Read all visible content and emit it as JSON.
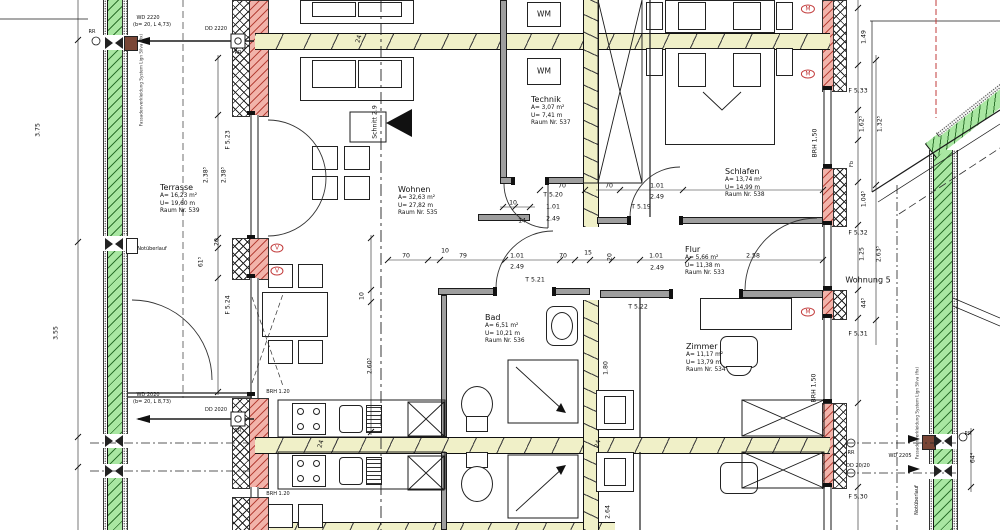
{
  "drawing": {
    "rooms": [
      {
        "id": "terrasse",
        "name": "Terrasse",
        "area": "A= 16,23 m²",
        "perimeter": "U= 19,60 m",
        "room_no": "Raum Nr. 539",
        "x": 160,
        "y": 183
      },
      {
        "id": "wohnen",
        "name": "Wohnen",
        "area": "A= 32,63 m²",
        "perimeter": "U= 27,82 m",
        "room_no": "Raum Nr. 535",
        "x": 398,
        "y": 185
      },
      {
        "id": "technik",
        "name": "Technik",
        "area": "A= 3,07 m²",
        "perimeter": "U= 7,41 m",
        "room_no": "Raum Nr. 537",
        "x": 531,
        "y": 95
      },
      {
        "id": "schlafen",
        "name": "Schlafen",
        "area": "A= 13,74 m²",
        "perimeter": "U= 14,99 m",
        "room_no": "Raum Nr. 538",
        "x": 725,
        "y": 167
      },
      {
        "id": "flur",
        "name": "Flur",
        "area": "A= 5,66 m²",
        "perimeter": "U= 11,38 m",
        "room_no": "Raum Nr. 533",
        "x": 685,
        "y": 245
      },
      {
        "id": "bad",
        "name": "Bad",
        "area": "A= 6,51 m²",
        "perimeter": "U= 10,21 m",
        "room_no": "Raum Nr. 536",
        "x": 485,
        "y": 313
      },
      {
        "id": "zimmer",
        "name": "Zimmer",
        "area": "A= 11,17 m²",
        "perimeter": "U= 13,79 m",
        "room_no": "Raum Nr. 534",
        "x": 686,
        "y": 342
      }
    ],
    "annotations": [
      {
        "t": "T 5.20",
        "x": 553,
        "y": 195
      },
      {
        "t": "1.01",
        "x": 553,
        "y": 207
      },
      {
        "t": "2.49",
        "x": 553,
        "y": 219
      },
      {
        "t": "10",
        "x": 513,
        "y": 203
      },
      {
        "t": "14",
        "x": 522,
        "y": 221
      },
      {
        "t": "T 5.19",
        "x": 641,
        "y": 207
      },
      {
        "t": "70",
        "x": 562,
        "y": 186
      },
      {
        "t": "70",
        "x": 609,
        "y": 186
      },
      {
        "t": "1.01",
        "x": 657,
        "y": 186
      },
      {
        "t": "2.49",
        "x": 657,
        "y": 197
      },
      {
        "t": "70",
        "x": 406,
        "y": 256
      },
      {
        "t": "10",
        "x": 445,
        "y": 251
      },
      {
        "t": "79",
        "x": 463,
        "y": 256
      },
      {
        "t": "1.01",
        "x": 517,
        "y": 256
      },
      {
        "t": "2.49",
        "x": 517,
        "y": 267
      },
      {
        "t": "T 5.21",
        "x": 535,
        "y": 280
      },
      {
        "t": "70",
        "x": 563,
        "y": 256
      },
      {
        "t": "15",
        "x": 588,
        "y": 253
      },
      {
        "t": "20",
        "x": 610,
        "y": 257,
        "r": -90
      },
      {
        "t": "1.01",
        "x": 656,
        "y": 256
      },
      {
        "t": "2.49",
        "x": 657,
        "y": 268
      },
      {
        "t": "2.58",
        "x": 753,
        "y": 256
      },
      {
        "t": "T 5.22",
        "x": 638,
        "y": 307
      },
      {
        "t": "24",
        "x": 359,
        "y": 39,
        "r": -75
      },
      {
        "t": "24",
        "x": 321,
        "y": 444,
        "r": -75
      },
      {
        "t": "24",
        "x": 598,
        "y": 444,
        "r": -75
      },
      {
        "t": "2.38⁵",
        "x": 206,
        "y": 175,
        "r": -90
      },
      {
        "t": "2.38⁵",
        "x": 224,
        "y": 175,
        "r": -90
      },
      {
        "t": "20",
        "x": 217,
        "y": 242,
        "r": -90
      },
      {
        "t": "61⁵",
        "x": 201,
        "y": 262,
        "r": -90
      },
      {
        "t": "3.75",
        "x": 38,
        "y": 130,
        "r": -90
      },
      {
        "t": "3.55",
        "x": 56,
        "y": 333,
        "r": -90
      },
      {
        "t": "2.60⁵",
        "x": 370,
        "y": 366,
        "r": -90
      },
      {
        "t": "10",
        "x": 362,
        "y": 296,
        "r": -90
      },
      {
        "t": "2.64",
        "x": 608,
        "y": 512,
        "r": -90
      },
      {
        "t": "1.80",
        "x": 606,
        "y": 368,
        "r": -90
      },
      {
        "t": "1.49",
        "x": 864,
        "y": 37,
        "r": -90
      },
      {
        "t": "1.62⁵",
        "x": 862,
        "y": 124,
        "r": -90
      },
      {
        "t": "1.32⁵",
        "x": 880,
        "y": 124,
        "r": -90
      },
      {
        "t": "1.04⁵",
        "x": 864,
        "y": 199,
        "r": -90
      },
      {
        "t": "1.25",
        "x": 862,
        "y": 254,
        "r": -90
      },
      {
        "t": "2.63⁵",
        "x": 879,
        "y": 254,
        "r": -90
      },
      {
        "t": "44⁵",
        "x": 864,
        "y": 303,
        "r": -90
      },
      {
        "t": "64⁴",
        "x": 973,
        "y": 458,
        "r": -90
      },
      {
        "t": "F 5.23",
        "x": 228,
        "y": 140,
        "r": -90
      },
      {
        "t": "F 5.24",
        "x": 228,
        "y": 305,
        "r": -90
      },
      {
        "t": "F 5.33",
        "x": 858,
        "y": 91
      },
      {
        "t": "F 5.32",
        "x": 858,
        "y": 233
      },
      {
        "t": "F 5.31",
        "x": 858,
        "y": 334
      },
      {
        "t": "F 5.30",
        "x": 858,
        "y": 497
      },
      {
        "t": "Wohnung 5",
        "x": 868,
        "y": 280,
        "c": "lbl9"
      },
      {
        "t": "BRH 1,50",
        "x": 815,
        "y": 143,
        "r": -90
      },
      {
        "t": "BRH 1,50",
        "x": 814,
        "y": 388,
        "r": -90
      },
      {
        "t": "BRH 1.20",
        "x": 278,
        "y": 392,
        "c": "tiny"
      },
      {
        "t": "BRH 1.20",
        "x": 278,
        "y": 494,
        "c": "tiny"
      },
      {
        "t": "WD 2220",
        "x": 148,
        "y": 18,
        "c": "tiny"
      },
      {
        "t": "(b= 20, L 4,73)",
        "x": 152,
        "y": 25,
        "c": "tiny"
      },
      {
        "t": "DD 2220",
        "x": 216,
        "y": 29,
        "c": "tiny"
      },
      {
        "t": "RR",
        "x": 92,
        "y": 32,
        "c": "tiny"
      },
      {
        "t": "RR",
        "x": 238,
        "y": 53,
        "c": "tiny"
      },
      {
        "t": "WD 2020",
        "x": 148,
        "y": 395,
        "c": "tiny"
      },
      {
        "t": "(b= 20, L 8,73)",
        "x": 152,
        "y": 402,
        "c": "tiny"
      },
      {
        "t": "DD 2020",
        "x": 216,
        "y": 410,
        "c": "tiny"
      },
      {
        "t": "RR",
        "x": 238,
        "y": 431,
        "c": "tiny"
      },
      {
        "t": "RR",
        "x": 851,
        "y": 453,
        "c": "tiny"
      },
      {
        "t": "DD 20/20",
        "x": 858,
        "y": 466,
        "c": "tiny"
      },
      {
        "t": "RR",
        "x": 968,
        "y": 434,
        "c": "tiny"
      },
      {
        "t": "WD 2205",
        "x": 900,
        "y": 456,
        "c": "tiny"
      },
      {
        "t": "Notüberlauf",
        "x": 152,
        "y": 249,
        "c": "tiny"
      },
      {
        "t": "Notüberlauf",
        "x": 917,
        "y": 500,
        "r": -90,
        "c": "tiny"
      },
      {
        "t": "Fassadenverkleidung System Lign Silva (fix)",
        "x": 141,
        "y": 80,
        "r": -90,
        "c": "micro"
      },
      {
        "t": "Fassadenverkleidung System Lign Silva (fix)",
        "x": 917,
        "y": 413,
        "r": -90,
        "c": "micro"
      },
      {
        "t": "Schnitt 2.9",
        "x": 375,
        "y": 122,
        "r": -90
      },
      {
        "t": "WM",
        "x": 544,
        "y": 14,
        "c": "lbl8"
      },
      {
        "t": "WM",
        "x": 544,
        "y": 71,
        "c": "lbl8"
      },
      {
        "t": "V",
        "x": 277,
        "y": 248,
        "c": "oval"
      },
      {
        "t": "V",
        "x": 277,
        "y": 271,
        "c": "oval"
      },
      {
        "t": "M",
        "x": 808,
        "y": 9,
        "c": "oval"
      },
      {
        "t": "M",
        "x": 808,
        "y": 74,
        "c": "oval"
      },
      {
        "t": "M",
        "x": 808,
        "y": 312,
        "c": "oval"
      },
      {
        "t": "Fb",
        "x": 852,
        "y": 164,
        "r": -90,
        "c": "tiny"
      }
    ],
    "colors": {
      "facade_green": "#a9e7a2",
      "insulation_red": "#f2b3aa",
      "beam_yellow": "#f0f0c8",
      "accent_red": "#c23b3b",
      "wall_gray": "#9e9e9e",
      "line": "#1b1b1b"
    }
  }
}
